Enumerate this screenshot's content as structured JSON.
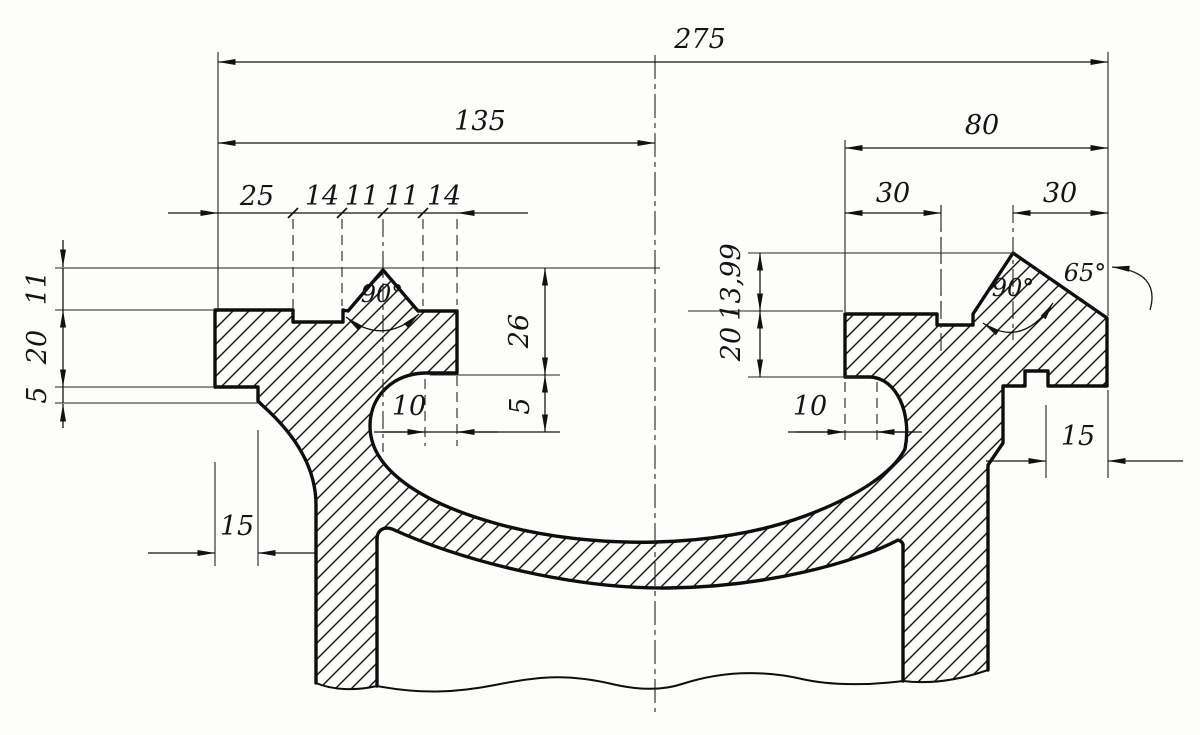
{
  "drawing": {
    "dimensions": {
      "overall_width": "275",
      "left_section_width": "135",
      "right_section_width": "80",
      "groove_offsets": [
        "25",
        "14",
        "11",
        "11",
        "14"
      ],
      "right_offsets": [
        "30",
        "30"
      ],
      "left_heights": [
        "11",
        "20",
        "5"
      ],
      "bowl_depth": "26",
      "bowl_step": "5",
      "undercut_left": "10",
      "undercut_right": "10",
      "right_heights": [
        "13,99",
        "20"
      ],
      "skirt_step_left": "15",
      "skirt_step_right": "15",
      "groove_angle_left": "90°",
      "groove_angle_right": "90°",
      "chamfer_angle": "65°"
    }
  }
}
